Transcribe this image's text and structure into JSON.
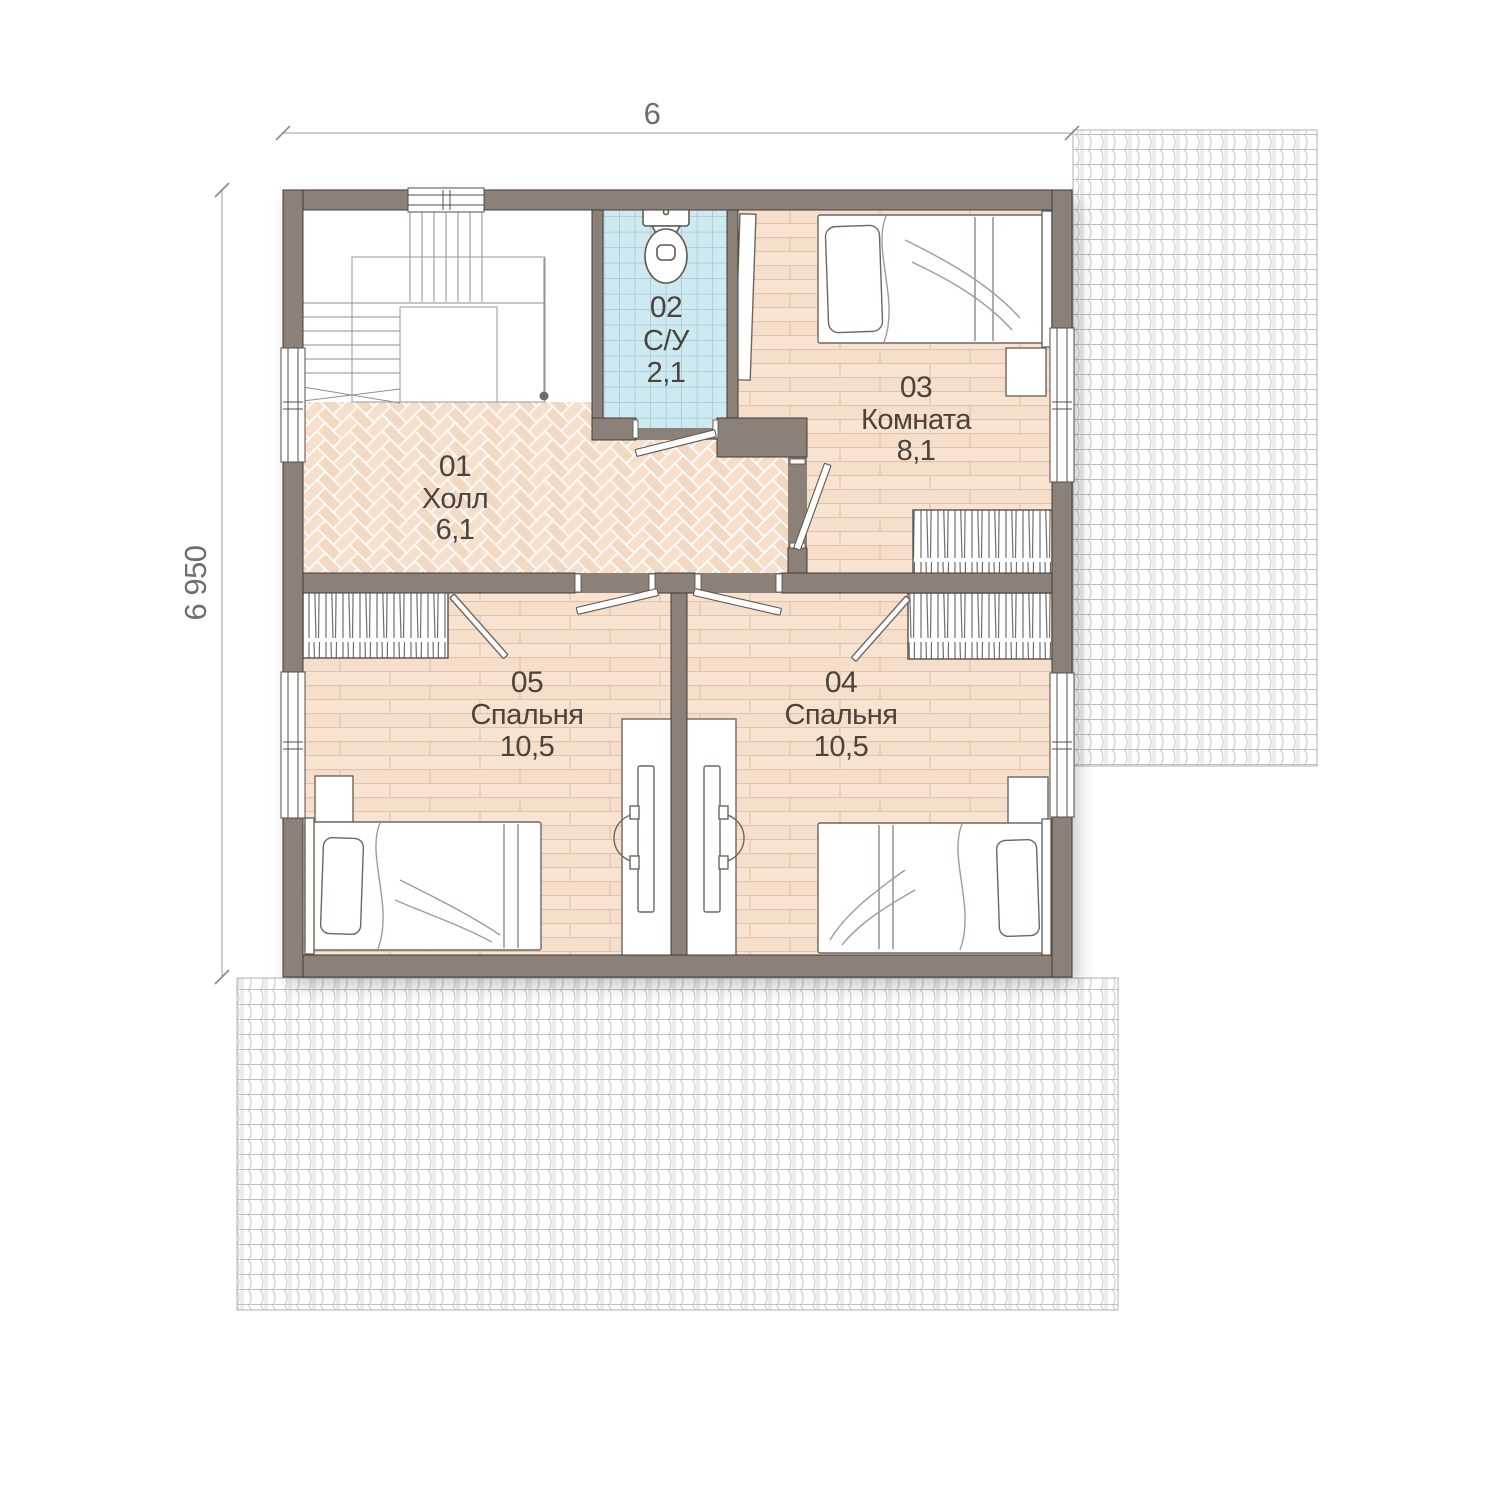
{
  "plan": {
    "dimensions": {
      "width_label": "6",
      "height_label": "6 950"
    },
    "rooms": [
      {
        "id": "01",
        "name": "Холл",
        "area": "6,1"
      },
      {
        "id": "02",
        "name": "С/У",
        "area": "2,1"
      },
      {
        "id": "03",
        "name": "Комната",
        "area": "8,1"
      },
      {
        "id": "04",
        "name": "Спальня",
        "area": "10,5"
      },
      {
        "id": "05",
        "name": "Спальня",
        "area": "10,5"
      }
    ],
    "colors": {
      "wall": "#8b8178",
      "floor_base": "#f8e3d1",
      "hall_floor": "#f4dbc6",
      "bath_tile": "#cfe9f1",
      "roof_line": "#c6c6c6",
      "label_text": "#4a443d",
      "dimension_text": "#6e6e6e"
    }
  }
}
